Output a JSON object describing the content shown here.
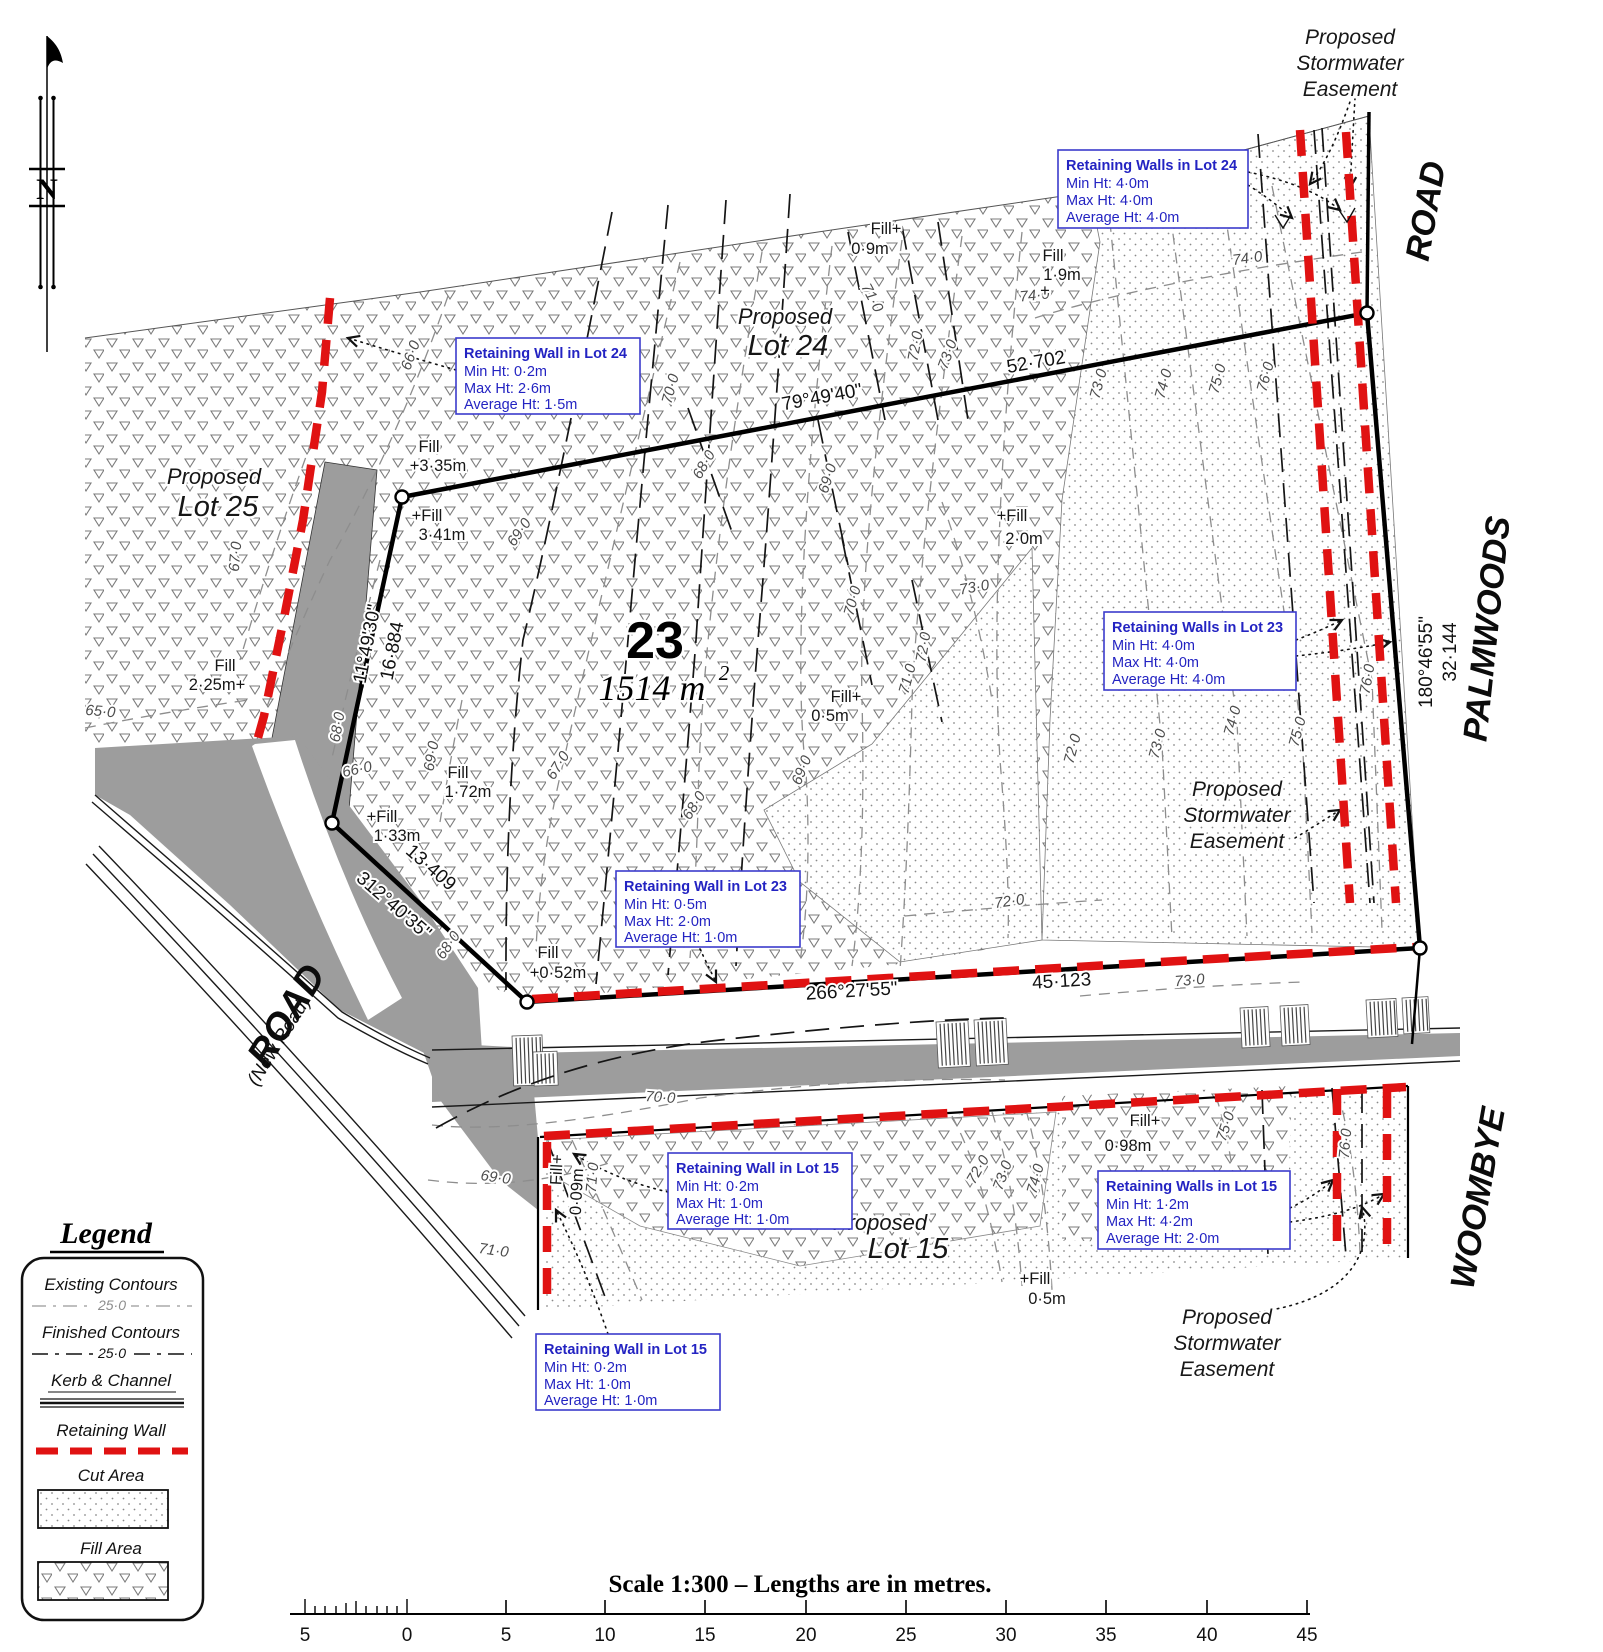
{
  "north": {
    "label": "N"
  },
  "lots": {
    "lot23": {
      "number": "23",
      "area": "1514 m",
      "sup": "2"
    },
    "lot24": {
      "l1": "Proposed",
      "l2": "Lot 24"
    },
    "lot25": {
      "l1": "Proposed",
      "l2": "Lot 25"
    },
    "lot15": {
      "l1": "Proposed",
      "l2": "Lot 15"
    }
  },
  "roads": {
    "road_top": "ROAD",
    "palmwoods": "PALMWOODS",
    "woombye": "WOOMBYE",
    "new_road": "ROAD",
    "new_road_sub": "(New Road)"
  },
  "easement": {
    "l1": "Proposed",
    "l2": "Stormwater",
    "l3": "Easement"
  },
  "bearings": {
    "top": {
      "angle": "79°49'40\"",
      "len": "52·702"
    },
    "left": {
      "angle": "11°49'30\"",
      "len": "16·884"
    },
    "lower_left": {
      "angle": "312°40'35\"",
      "len": "13·409"
    },
    "bottom": {
      "angle": "266°27'55\"",
      "len": "45·123"
    },
    "right": {
      "angle": "180°46'55\"",
      "len": "32·144"
    }
  },
  "callouts": [
    {
      "title": "Retaining Walls in Lot 24",
      "min": "Min Ht:  4·0m",
      "max": "Max Ht:  4·0m",
      "avg": "Average Ht:  4·0m"
    },
    {
      "title": "Retaining Wall in Lot 24",
      "min": "Min Ht:  0·2m",
      "max": "Max Ht:  2·6m",
      "avg": "Average Ht:  1·5m"
    },
    {
      "title": "Retaining Walls in Lot 23",
      "min": "Min Ht:  4·0m",
      "max": "Max Ht:  4·0m",
      "avg": "Average Ht:  4·0m"
    },
    {
      "title": "Retaining Wall in Lot 23",
      "min": "Min Ht:  0·5m",
      "max": "Max Ht:  2·0m",
      "avg": "Average Ht:  1·0m"
    },
    {
      "title": "Retaining Wall in Lot 15",
      "min": "Min Ht:  0·2m",
      "max": "Max Ht:  1·0m",
      "avg": "Average Ht:  1·0m"
    },
    {
      "title": "Retaining Walls in Lot 15",
      "min": "Min Ht:  1·2m",
      "max": "Max Ht:  4·2m",
      "avg": "Average Ht:  2·0m"
    },
    {
      "title": "Retaining Wall in Lot 15",
      "min": "Min Ht:  0·2m",
      "max": "Max Ht:  1·0m",
      "avg": "Average Ht:  1·0m"
    }
  ],
  "fills": [
    {
      "l1": "Fill+",
      "l2": "0·9m"
    },
    {
      "l1": "Fill",
      "l2": "1·9m",
      "plus": "+"
    },
    {
      "l1": "Fill",
      "l2": "+3·35m"
    },
    {
      "l1": "+Fill",
      "l2": "3·41m"
    },
    {
      "l1": "Fill",
      "l2": "2·25m+"
    },
    {
      "l1": "Fill",
      "l2": "1·72m"
    },
    {
      "l1": "+Fill",
      "l2": "1·33m"
    },
    {
      "l1": "+Fill",
      "l2": "2·0m"
    },
    {
      "l1": "Fill+",
      "l2": "0·5m"
    },
    {
      "l1": "Fill",
      "l2": "+0·52m"
    },
    {
      "l1": "Fill+",
      "l2": "0·98m"
    },
    {
      "l1": "+Fill",
      "l2": "0·5m"
    },
    {
      "l1": "Fill+",
      "l2": "0·09m"
    }
  ],
  "contours": [
    "65·0",
    "66·0",
    "67·0",
    "68·0",
    "66·0",
    "69·0",
    "68·0",
    "67·0",
    "68·0",
    "69·0",
    "70·0",
    "69·0",
    "70·0",
    "69·0",
    "71·0",
    "72·0",
    "73·0",
    "72·0",
    "68·0",
    "71·0",
    "72·0",
    "73·0",
    "73·0",
    "74·0",
    "74·0",
    "73·0",
    "74·0",
    "75·0",
    "76·0",
    "72·0",
    "73·0",
    "74·0",
    "75·0",
    "76·0",
    "70·0",
    "69·0",
    "71·0",
    "71·0",
    "72·0",
    "73·0",
    "74·0",
    "75·0",
    "76·0"
  ],
  "legend": {
    "title": "Legend",
    "existing": {
      "label": "Existing Contours",
      "value": "25·0"
    },
    "finished": {
      "label": "Finished Contours",
      "value": "25·0"
    },
    "kerb": {
      "label": "Kerb & Channel"
    },
    "wall": {
      "label": "Retaining Wall"
    },
    "cut": {
      "label": "Cut Area"
    },
    "fill": {
      "label": "Fill Area"
    }
  },
  "scale": {
    "caption": "Scale 1:300  –  Lengths are in metres.",
    "ticks": [
      "5",
      "0",
      "5",
      "10",
      "15",
      "20",
      "25",
      "30",
      "35",
      "40",
      "45"
    ]
  },
  "colors": {
    "retaining_wall": "#e01212",
    "callout_blue": "#2323c2",
    "road_gray": "#9d9d9d"
  }
}
